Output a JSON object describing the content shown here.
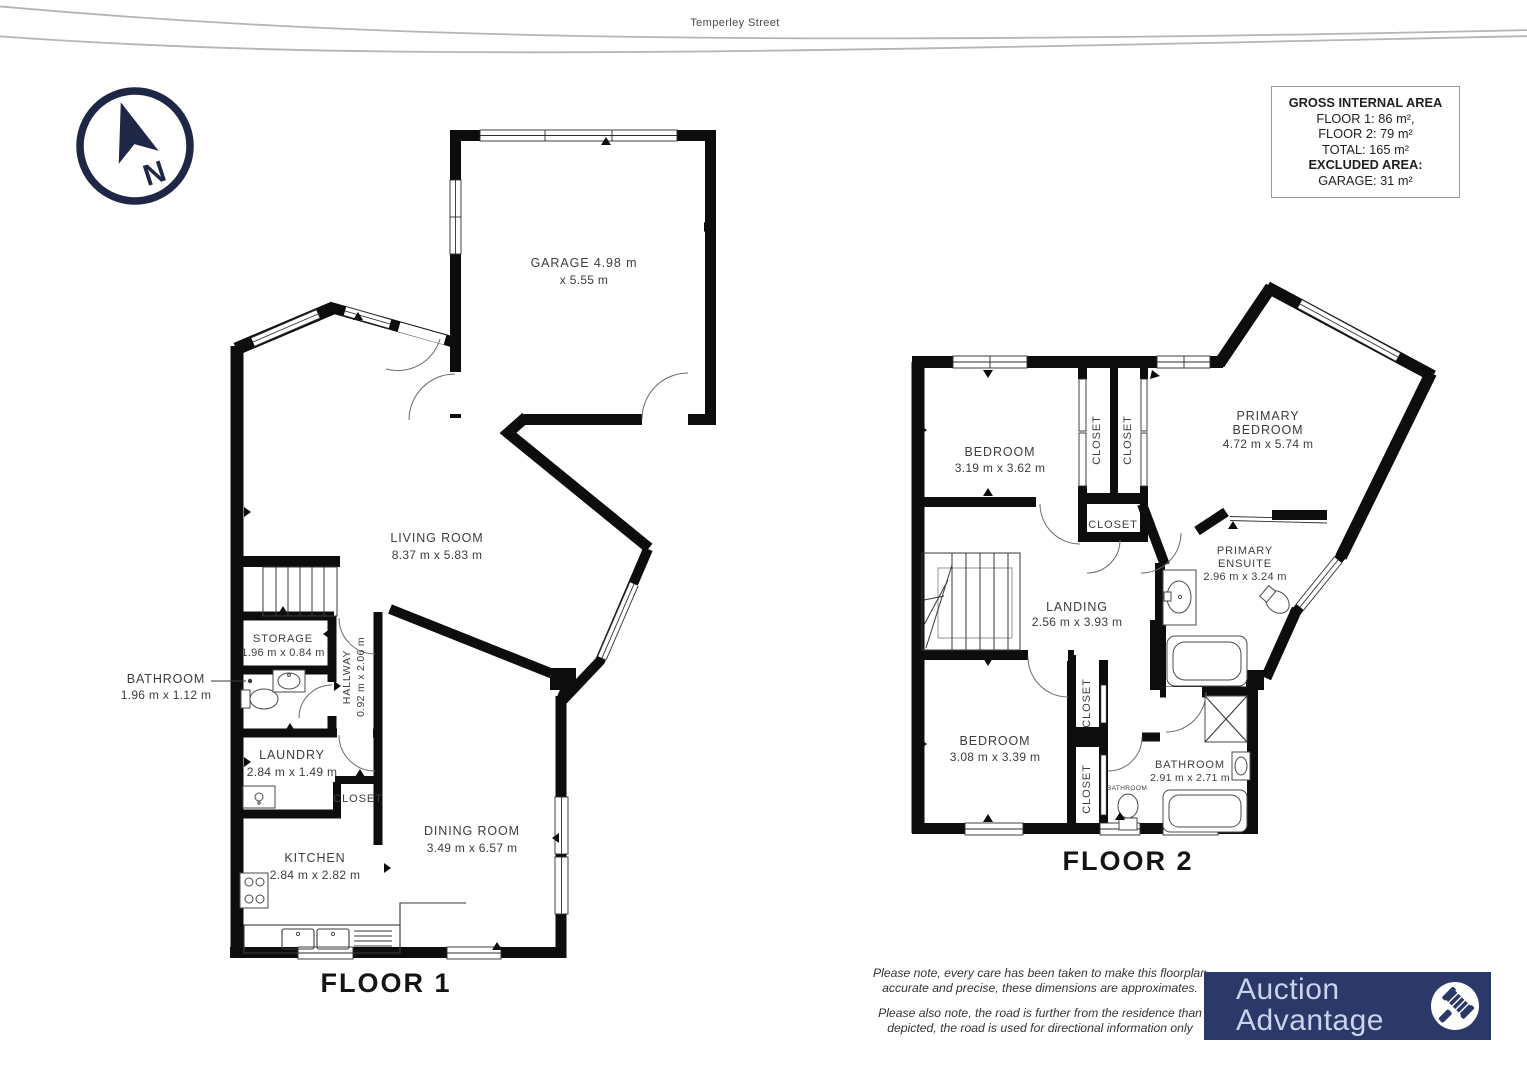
{
  "street": {
    "name": "Temperley Street"
  },
  "compass": {
    "letter": "N"
  },
  "colors": {
    "wall": "#0d0d0d",
    "compass_navy": "#1e2746",
    "logo_background": "#2c3968",
    "logo_text": "#c9d3ee",
    "road_gray": "#b5b5b5"
  },
  "area_summary": {
    "title": "GROSS INTERNAL AREA",
    "floor1": "FLOOR 1: 86 m²,",
    "floor2": "FLOOR 2: 79 m²",
    "total": "TOTAL: 165 m²",
    "excluded_title": "EXCLUDED AREA:",
    "excluded_garage": "GARAGE: 31 m²"
  },
  "floor1": {
    "title": "FLOOR 1",
    "rooms": {
      "garage": {
        "line1": "GARAGE 4.98 m",
        "line2": "x 5.55 m"
      },
      "living": {
        "name": "LIVING ROOM",
        "dims": "8.37 m x 5.83 m"
      },
      "storage": {
        "name": "STORAGE",
        "dims": "1.96 m x 0.84 m"
      },
      "bathroom": {
        "name": "BATHROOM",
        "dims": "1.96 m x 1.12 m"
      },
      "hallway": {
        "name": "HALLWAY",
        "dims": "0.92 m x 2.06 m"
      },
      "laundry": {
        "name": "LAUNDRY",
        "dims": "2.84 m x 1.49 m"
      },
      "closet": {
        "name": "CLOSET"
      },
      "kitchen": {
        "name": "KITCHEN",
        "dims": "2.84 m x 2.82 m"
      },
      "dining": {
        "name": "DINING ROOM",
        "dims": "3.49 m x 6.57 m"
      }
    }
  },
  "floor2": {
    "title": "FLOOR 2",
    "rooms": {
      "bedroom1": {
        "name": "BEDROOM",
        "dims": "3.19 m x 3.62 m"
      },
      "closet1": {
        "name": "CLOSET"
      },
      "closet2": {
        "name": "CLOSET"
      },
      "closet3": {
        "name": "CLOSET"
      },
      "primary_bedroom": {
        "line1": "PRIMARY",
        "line2": "BEDROOM",
        "dims": "4.72 m x 5.74 m"
      },
      "primary_ensuite": {
        "line1": "PRIMARY",
        "line2": "ENSUITE",
        "dims": "2.96 m x 3.24 m"
      },
      "landing": {
        "name": "LANDING",
        "dims": "2.56 m x 3.93 m"
      },
      "bedroom2": {
        "name": "BEDROOM",
        "dims": "3.08 m x 3.39 m"
      },
      "closet4": {
        "name": "CLOSET"
      },
      "closet5": {
        "name": "CLOSET"
      },
      "bathroom_small": {
        "name": "BATHROOM"
      },
      "bathroom": {
        "name": "BATHROOM",
        "dims": "2.91 m x 2.71 m"
      }
    }
  },
  "notes": {
    "line1": "Please note, every care has been taken to make this floorplan",
    "line2": "accurate and precise, these dimensions are approximates.",
    "line3": "Please also note, the road is further from the residence than",
    "line4": "depicted, the road is used for directional information only"
  },
  "logo": {
    "line1": "Auction",
    "line2": "Advantage"
  }
}
